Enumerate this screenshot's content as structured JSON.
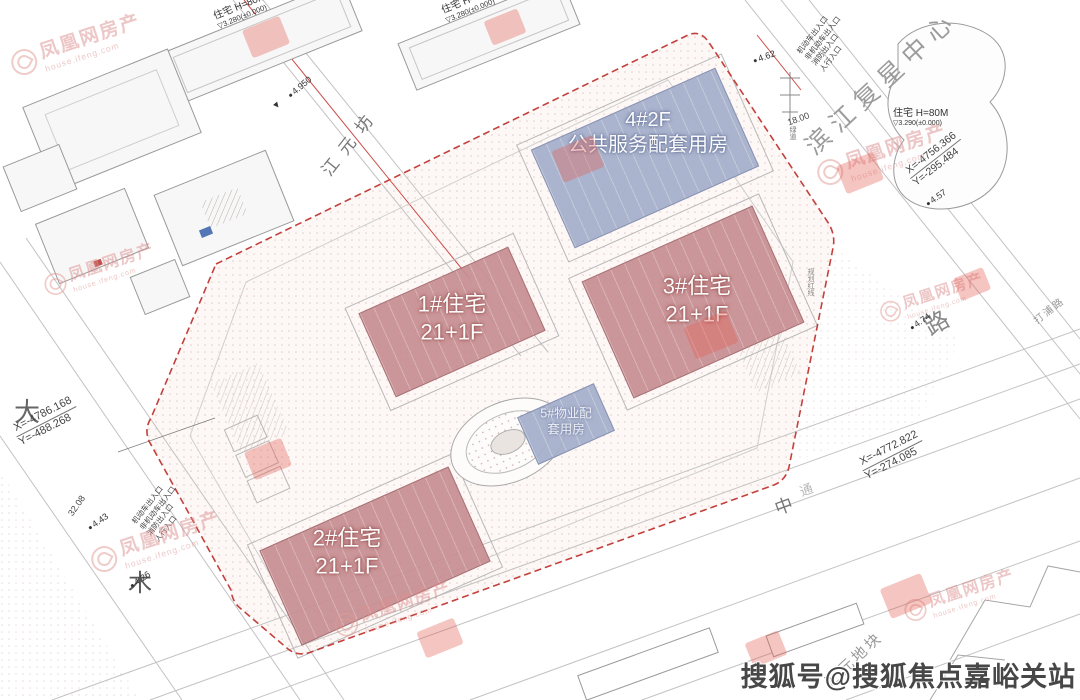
{
  "drawing": {
    "buildings": {
      "b1": {
        "name": "1#住宅",
        "floors": "21+1F"
      },
      "b2": {
        "name": "2#住宅",
        "floors": "21+1F"
      },
      "b3": {
        "name": "3#住宅",
        "floors": "21+1F"
      },
      "b4": {
        "name": "4#2F",
        "use": "公共服务配套用房"
      },
      "b5": {
        "line1": "5#物业配",
        "line2": "套用房"
      }
    },
    "neighbors": {
      "top_slab": {
        "label": "住宅 H=80M",
        "elev": "3.280(±0.000)"
      },
      "right_parcel": {
        "label": "住宅 H=80M",
        "elev": "3.290(±0.000)"
      }
    },
    "streets": {
      "top_left_road": "江元坊",
      "top_right": "滨江复星中心",
      "left_char_1": "大",
      "left_char_2": "木",
      "right_char": "路",
      "right_small": "打浦路",
      "bottom_char_1": "中",
      "bottom_char_2": "通",
      "parcel_label": "汇元地块",
      "red_line_label": "规划红线",
      "greenway": "绿道"
    },
    "coords": {
      "left_x": "X=-4786.168",
      "left_y": "Y=-488.268",
      "rt_x": "X=-4756.366",
      "rt_y": "Y=-295.484",
      "rb_x": "X=-4772.822",
      "rb_y": "Y=-274.085"
    },
    "elevations": {
      "e1": "4.950",
      "e2": "4.62",
      "e3": "4.74",
      "e4": "4.43",
      "e5": "4.26",
      "e6": "4.57"
    },
    "dims": {
      "d1": "32.08",
      "d2": "18.00"
    },
    "entrances": [
      "机动车出入口",
      "非机动车出入口",
      "消防出入口",
      "人行入口"
    ],
    "icons": {
      "level_mark": "▽",
      "spot_mark": "▼"
    }
  },
  "watermarks": {
    "phoenix": "凤凰网房产",
    "phoenix_sub": "house.ifeng.com",
    "sohu": "搜狐号@搜狐焦点嘉峪关站"
  },
  "colors": {
    "residential": "#c88e92",
    "public": "#a5afcb",
    "boundary": "#c3403c"
  }
}
